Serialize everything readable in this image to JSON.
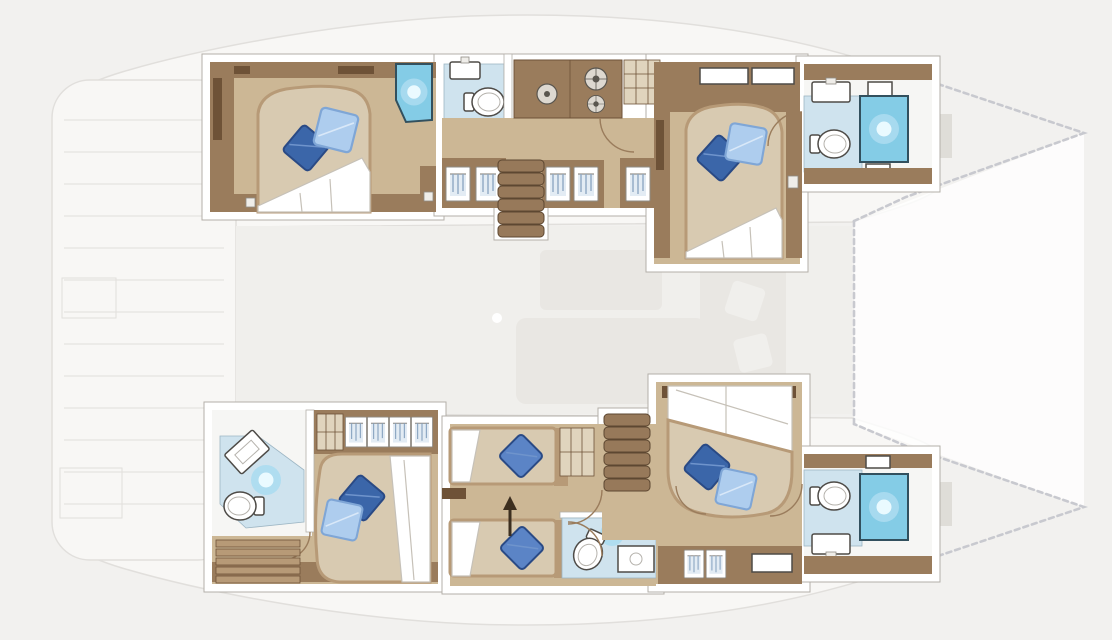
{
  "canvas": {
    "width": 1112,
    "height": 640
  },
  "plan": {
    "kind": "catamaran yacht lower-deck floor plan",
    "orientation": {
      "bow": "right",
      "stern": "left",
      "top_hull": "port",
      "bottom_hull": "starboard"
    },
    "summary": {
      "sleeping_cabins": 5,
      "double_beds": 4,
      "single_beds": 2,
      "bathrooms": 5,
      "companionway_stairs": 2
    },
    "hulls": [
      {
        "id": "port-hull",
        "position": "top",
        "rooms": [
          {
            "id": "aft-port-cabin",
            "type": "double-cabin",
            "fixtures": [
              "island-double-bed",
              "duvet",
              "pillow-dark-blue",
              "pillow-light-blue",
              "corner-shower",
              "wardrobe-shelves",
              "side-lockers"
            ]
          },
          {
            "id": "aft-port-bathroom",
            "type": "bathroom",
            "fixtures": [
              "washbasin",
              "toilet",
              "double-door"
            ]
          },
          {
            "id": "port-galley-corridor",
            "type": "galley-corridor",
            "fixtures": [
              "galley-sink",
              "stove-two-burners",
              "storage-cabinet",
              "hanging-lockers",
              "companionway-stairs",
              "door"
            ]
          },
          {
            "id": "forward-port-cabin",
            "type": "double-cabin",
            "fixtures": [
              "island-double-bed",
              "duvet",
              "pillow-dark-blue",
              "pillow-light-blue",
              "headboard-shelf",
              "side-lockers",
              "door"
            ]
          },
          {
            "id": "port-bow-bathroom",
            "type": "bathroom",
            "fixtures": [
              "shower-cabin",
              "toilet",
              "washbasin",
              "vanity-shelves"
            ]
          }
        ]
      },
      {
        "id": "starboard-hull",
        "position": "bottom",
        "rooms": [
          {
            "id": "aft-starboard-cabin",
            "type": "double-cabin-ensuite",
            "fixtures": [
              "corner-shower",
              "angled-washbasin",
              "toilet",
              "hanging-wardrobe",
              "shelf-unit",
              "island-double-bed",
              "duvet",
              "pillow-dark-blue",
              "pillow-light-blue",
              "step-slats",
              "door"
            ]
          },
          {
            "id": "starboard-twin-cabin",
            "type": "twin-cabin-ensuite",
            "fixtures": [
              "single-bed",
              "single-bed",
              "pillow-blue",
              "pillow-blue",
              "sliding-beds-arrow",
              "shower-room",
              "toilet",
              "washbasin",
              "shelf-unit",
              "double-door"
            ]
          },
          {
            "id": "starboard-companionway",
            "type": "stairs",
            "fixtures": [
              "companionway-stairs"
            ]
          },
          {
            "id": "forward-starboard-cabin",
            "type": "double-cabin",
            "fixtures": [
              "island-double-bed",
              "duvet",
              "pillow-dark-blue",
              "pillow-light-blue",
              "hanging-lockers",
              "vanity-shelf",
              "doors"
            ]
          },
          {
            "id": "starboard-bow-bathroom",
            "type": "bathroom",
            "fixtures": [
              "shower-cabin",
              "toilet",
              "washbasin",
              "vanity-shelves"
            ]
          }
        ]
      }
    ],
    "ghosted_areas": [
      {
        "id": "aft-cockpit-platform"
      },
      {
        "id": "saloon"
      },
      {
        "id": "foredeck-trampoline"
      },
      {
        "id": "bow-rope-outlines"
      },
      {
        "id": "windlass-pads"
      }
    ]
  },
  "colors": {
    "bg": "#f2f1ef",
    "ghost_fill": "#f8f7f5",
    "ghost_line": "#e1dfdc",
    "saloon_fill": "#f0efec",
    "ghost_furniture": "#e9e7e3",
    "dash": "#c8c9cf",
    "wall": "#ffffff",
    "wall_edge": "#b3afa9",
    "wood_dark": "#6e5237",
    "wood": "#9a7c5c",
    "wood_light": "#b79a77",
    "floor_tan": "#ccb795",
    "floor_pale": "#e0d4bd",
    "bed": "#d8cab1",
    "duvet": "#ffffff",
    "duvet_line": "#c6c1b8",
    "bath_floor": "#cfe3ee",
    "bath_white": "#f6f6f4",
    "shower": "#84cce6",
    "shower_edge": "#32505e",
    "shower_mid": "#abdcf0",
    "shower_glow": "#eafaff",
    "pillow_dark": "#3b66a9",
    "pillow_dark_edge": "#2a4a85",
    "pillow_mid": "#5b84c6",
    "pillow_light": "#aecdee",
    "pillow_light_edge": "#7fa6d6",
    "stair": "#97795a",
    "stair_line": "#5d4731",
    "arrow": "#3c2f20",
    "fixture_edge": "#4e4b47"
  }
}
